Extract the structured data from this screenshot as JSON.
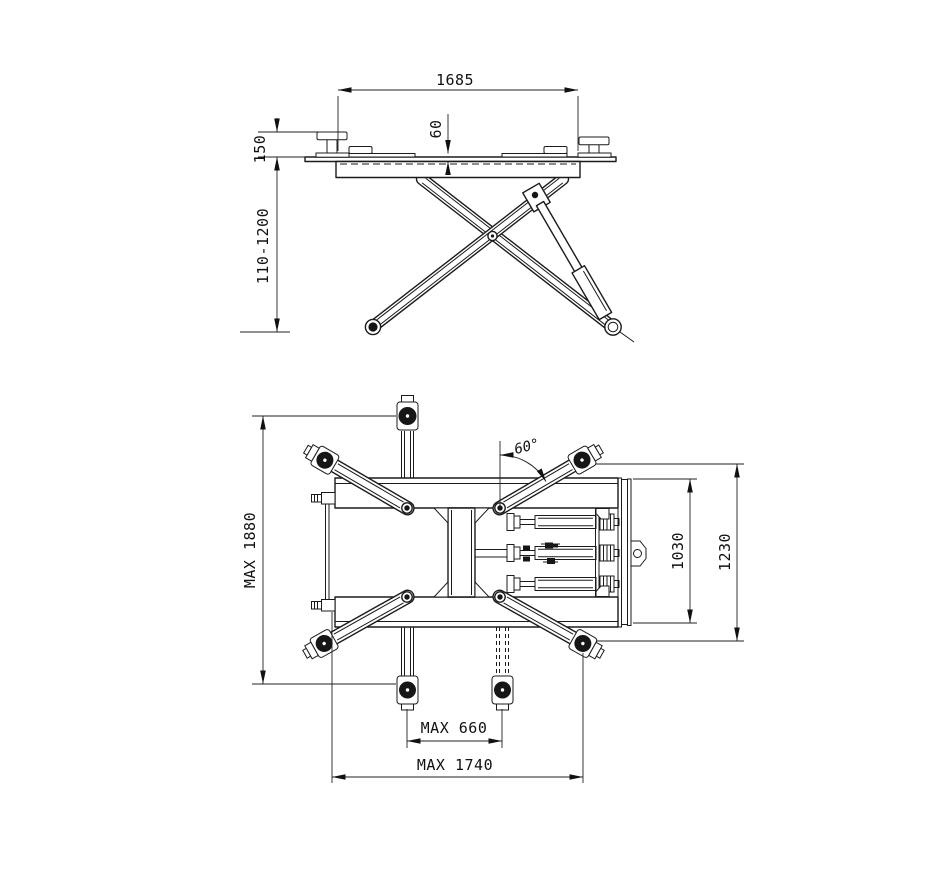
{
  "drawing": {
    "side_view": {
      "overall_width": "1685",
      "pad_offset": "60",
      "pad_height": "150",
      "lift_range": "110-1200"
    },
    "plan_view": {
      "max_length": "MAX 1880",
      "swing_angle": "60°",
      "frame_width": "1030",
      "overall_width": "1230",
      "min_arm_span": "MAX 660",
      "max_arm_span": "MAX 1740"
    }
  }
}
